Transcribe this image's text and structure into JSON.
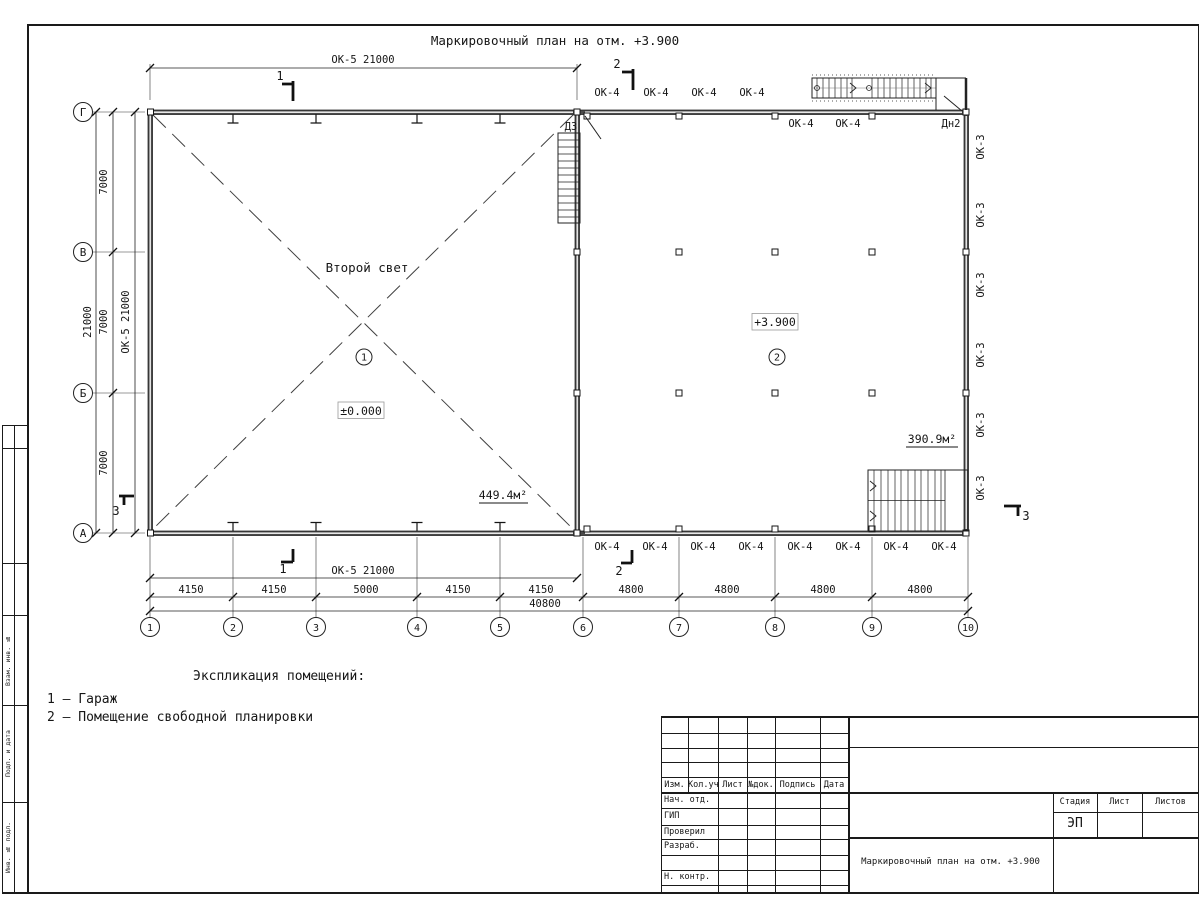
{
  "sheet_title": "Маркировочный план на отм. +3.900",
  "legend": {
    "heading": "Экспликация помещений:",
    "items": [
      "1 – Гараж",
      "2 – Помещение свободной планировки"
    ]
  },
  "axes": {
    "letters": [
      {
        "label": "Г",
        "y": 112
      },
      {
        "label": "В",
        "y": 252
      },
      {
        "label": "Б",
        "y": 393
      },
      {
        "label": "А",
        "y": 533
      }
    ],
    "numbers": [
      {
        "label": "1",
        "x": 150
      },
      {
        "label": "2",
        "x": 233
      },
      {
        "label": "3",
        "x": 316
      },
      {
        "label": "4",
        "x": 417
      },
      {
        "label": "5",
        "x": 500
      },
      {
        "label": "6",
        "x": 583
      },
      {
        "label": "7",
        "x": 679
      },
      {
        "label": "8",
        "x": 775
      },
      {
        "label": "9",
        "x": 872
      },
      {
        "label": "10",
        "x": 968
      }
    ]
  },
  "room_marks": [
    {
      "num": "1",
      "x": 364,
      "y": 357
    },
    {
      "num": "2",
      "x": 777,
      "y": 357
    }
  ],
  "plan_labels": [
    {
      "t": "ОК-5 21000",
      "x": 363,
      "y": 63,
      "n": "dim-ok5-top"
    },
    {
      "t": "1",
      "x": 280,
      "y": 80,
      "s": 12,
      "n": "section-mark-1-top"
    },
    {
      "t": "2",
      "x": 617,
      "y": 68,
      "s": 12,
      "n": "section-mark-2-top"
    },
    {
      "t": "ОК-4",
      "x": 607,
      "y": 96,
      "n": "window-ok4"
    },
    {
      "t": "ОК-4",
      "x": 656,
      "y": 96,
      "n": "window-ok4"
    },
    {
      "t": "ОК-4",
      "x": 704,
      "y": 96,
      "n": "window-ok4"
    },
    {
      "t": "ОК-4",
      "x": 752,
      "y": 96,
      "n": "window-ok4"
    },
    {
      "t": "ОК-4",
      "x": 801,
      "y": 127,
      "n": "window-ok4"
    },
    {
      "t": "ОК-4",
      "x": 848,
      "y": 127,
      "n": "window-ok4"
    },
    {
      "t": "Дн2",
      "x": 951,
      "y": 127,
      "n": "door-dn2"
    },
    {
      "t": "Д3",
      "x": 571,
      "y": 130,
      "n": "door-d3"
    },
    {
      "t": "ОК-3",
      "x": 984,
      "y": 147,
      "rot": -90,
      "n": "window-ok3"
    },
    {
      "t": "ОК-3",
      "x": 984,
      "y": 215,
      "rot": -90,
      "n": "window-ok3"
    },
    {
      "t": "ОК-3",
      "x": 984,
      "y": 285,
      "rot": -90,
      "n": "window-ok3"
    },
    {
      "t": "ОК-3",
      "x": 984,
      "y": 355,
      "rot": -90,
      "n": "window-ok3"
    },
    {
      "t": "ОК-3",
      "x": 984,
      "y": 425,
      "rot": -90,
      "n": "window-ok3"
    },
    {
      "t": "ОК-3",
      "x": 984,
      "y": 488,
      "rot": -90,
      "n": "window-ok3"
    },
    {
      "t": "21000",
      "x": 91,
      "y": 322,
      "rot": -90,
      "n": "dim-21000-left"
    },
    {
      "t": "7000",
      "x": 107,
      "y": 182,
      "rot": -90,
      "n": "dim-7000"
    },
    {
      "t": "7000",
      "x": 107,
      "y": 322,
      "rot": -90,
      "n": "dim-7000"
    },
    {
      "t": "7000",
      "x": 107,
      "y": 463,
      "rot": -90,
      "n": "dim-7000"
    },
    {
      "t": "ОК-5 21000",
      "x": 129,
      "y": 322,
      "rot": -90,
      "n": "dim-ok5-left"
    },
    {
      "t": "Второй свет",
      "x": 367,
      "y": 272,
      "s": 12.5,
      "n": "second-light-note"
    },
    {
      "t": "±0.000",
      "x": 361,
      "y": 415,
      "s": 11.5,
      "n": "elevation-0"
    },
    {
      "t": "+3.900",
      "x": 775,
      "y": 326,
      "s": 11.5,
      "n": "elevation-3900"
    },
    {
      "t": "449.4м²",
      "x": 503,
      "y": 499,
      "s": 11.5,
      "n": "room-area-1"
    },
    {
      "t": "390.9м²",
      "x": 932,
      "y": 443,
      "s": 11.5,
      "n": "room-area-2"
    },
    {
      "t": "ОК-4",
      "x": 607,
      "y": 550,
      "n": "window-ok4"
    },
    {
      "t": "ОК-4",
      "x": 655,
      "y": 550,
      "n": "window-ok4"
    },
    {
      "t": "ОК-4",
      "x": 703,
      "y": 550,
      "n": "window-ok4"
    },
    {
      "t": "ОК-4",
      "x": 751,
      "y": 550,
      "n": "window-ok4"
    },
    {
      "t": "ОК-4",
      "x": 800,
      "y": 550,
      "n": "window-ok4"
    },
    {
      "t": "ОК-4",
      "x": 848,
      "y": 550,
      "n": "window-ok4"
    },
    {
      "t": "ОК-4",
      "x": 896,
      "y": 550,
      "n": "window-ok4"
    },
    {
      "t": "ОК-4",
      "x": 944,
      "y": 550,
      "n": "window-ok4"
    },
    {
      "t": "1",
      "x": 283,
      "y": 573,
      "s": 12,
      "n": "section-mark-1-bottom"
    },
    {
      "t": "2",
      "x": 619,
      "y": 575,
      "s": 12,
      "n": "section-mark-2-bottom"
    },
    {
      "t": "3",
      "x": 116,
      "y": 515,
      "s": 12,
      "n": "section-mark-3-left"
    },
    {
      "t": "3",
      "x": 1026,
      "y": 520,
      "s": 12,
      "n": "section-mark-3-right"
    },
    {
      "t": "ОК-5 21000",
      "x": 363,
      "y": 574,
      "n": "dim-ok5-bottom"
    },
    {
      "t": "4150",
      "x": 191,
      "y": 593,
      "n": "dim-4150"
    },
    {
      "t": "4150",
      "x": 274,
      "y": 593,
      "n": "dim-4150"
    },
    {
      "t": "5000",
      "x": 366,
      "y": 593,
      "n": "dim-5000"
    },
    {
      "t": "4150",
      "x": 458,
      "y": 593,
      "n": "dim-4150"
    },
    {
      "t": "4150",
      "x": 541,
      "y": 593,
      "n": "dim-4150"
    },
    {
      "t": "4800",
      "x": 631,
      "y": 593,
      "n": "dim-4800"
    },
    {
      "t": "4800",
      "x": 727,
      "y": 593,
      "n": "dim-4800"
    },
    {
      "t": "4800",
      "x": 823,
      "y": 593,
      "n": "dim-4800"
    },
    {
      "t": "4800",
      "x": 920,
      "y": 593,
      "n": "dim-4800"
    },
    {
      "t": "40800",
      "x": 545,
      "y": 607,
      "n": "dim-40800"
    }
  ],
  "titleblock": {
    "header_cols": [
      "Изм.",
      "Кол.уч",
      "Лист",
      "№док.",
      "Подпись",
      "Дата"
    ],
    "row_labels": [
      "Нач. отд.",
      "ГИП",
      "Проверил",
      "Разраб.",
      "",
      "Н. контр."
    ],
    "stage_header": "Стадия",
    "sheet_header": "Лист",
    "sheets_header": "Листов",
    "stage_value": "ЭП",
    "doc_title": "Маркировочный план на отм. +3.900"
  },
  "side_strip": {
    "labels": [
      "Взам. инв. №",
      "Подп. и дата",
      "Инв. № подл."
    ]
  }
}
